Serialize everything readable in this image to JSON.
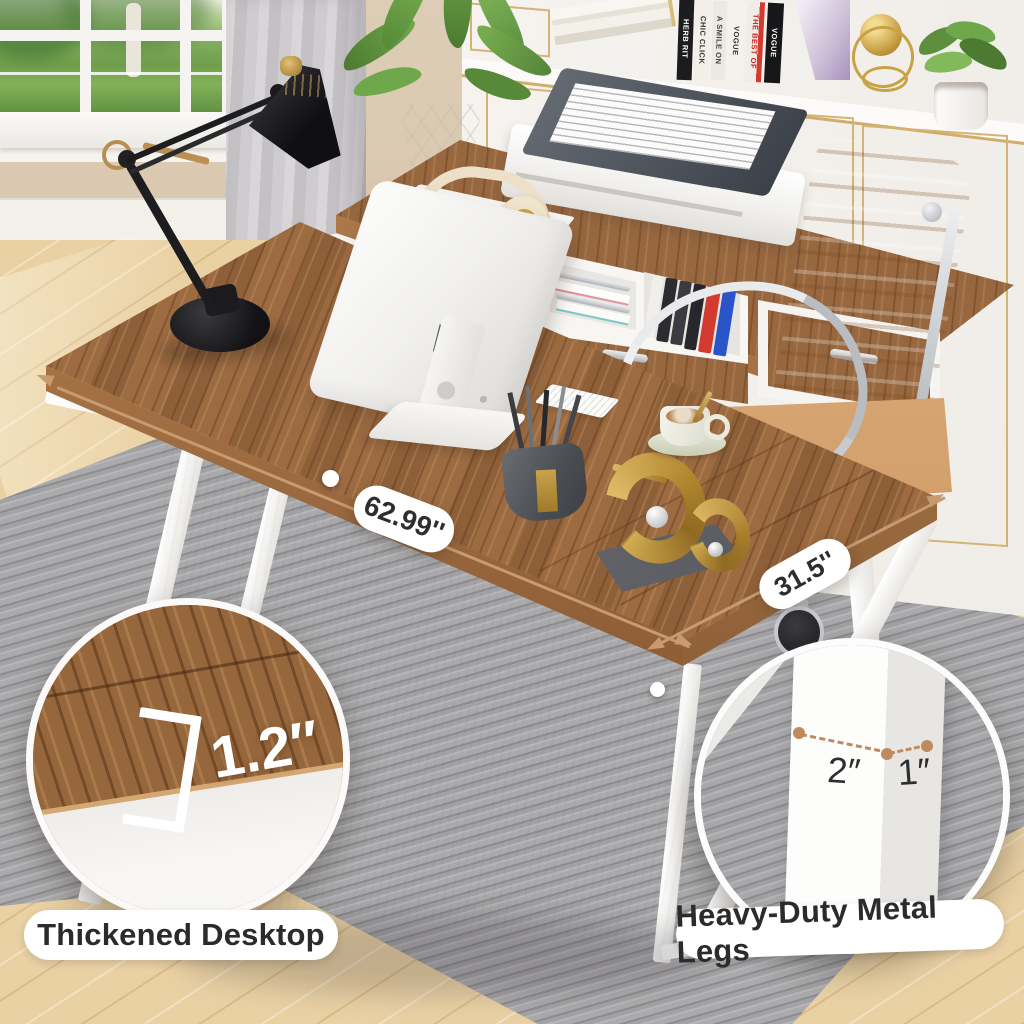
{
  "annotations": {
    "desk_width": "62.99''",
    "desk_depth": "31.5''",
    "desktop_thickness": "1.2″",
    "leg_width": "2″",
    "leg_depth": "1″",
    "caption_left": "Thickened Desktop",
    "caption_right": "Heavy-Duty Metal Legs"
  },
  "decor": {
    "book_spines": [
      "HERB RIT",
      "CHIC CLICK",
      "A SMILE ON",
      "VOGUE",
      "THE BEST OF",
      "VOGUE"
    ]
  },
  "colors": {
    "desk_wood": "#9c6b42",
    "floor_wood": "#ead1a4",
    "rug": "#a2a1a3",
    "chair_leather": "#d2a170",
    "metal_gold": "#c9a243",
    "arrow_copper": "#c79a6f",
    "cabinet_trim_gold": "#d4b476",
    "label_text": "#2b2b2b",
    "leg_white": "#f6f5f2"
  }
}
